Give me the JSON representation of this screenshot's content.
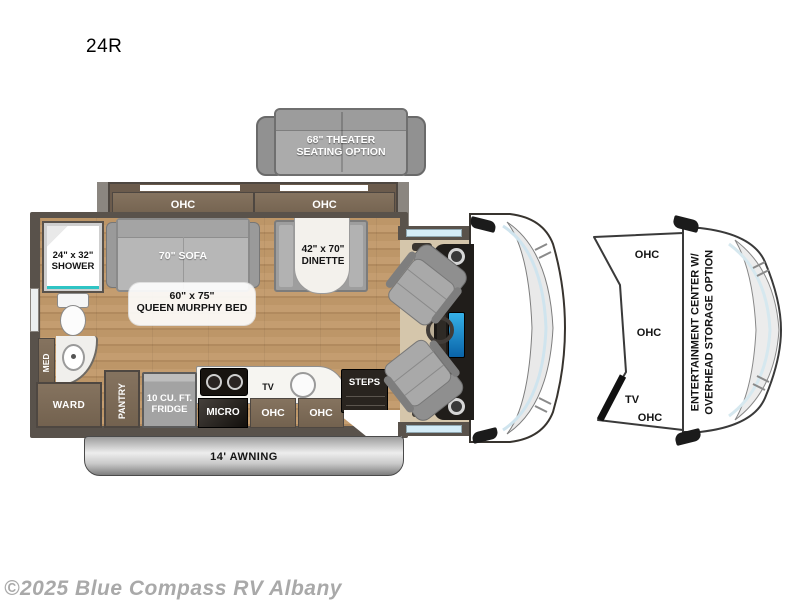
{
  "page": {
    "title": "24R",
    "watermark": "©2025 Blue Compass RV Albany"
  },
  "colors": {
    "accent_teal": "#2fc4c4",
    "wood_floor": "#c09a6e",
    "wall": "#59524b",
    "cabinet_brown": "#7b6a59",
    "infotainment_blue": "#2f9fd8",
    "awning_silver": "#c8c8c8",
    "watermark_gray": "#a9a9a9"
  },
  "floorplan": {
    "theater": {
      "line1": "68\" THEATER",
      "line2": "SEATING OPTION"
    },
    "slideout": {
      "ohc_left": "OHC",
      "ohc_right": "OHC"
    },
    "sofa": {
      "label": "70\" SOFA"
    },
    "murphy_bed": {
      "line1": "60\" x 75\"",
      "line2": "QUEEN MURPHY BED"
    },
    "dinette": {
      "line1": "42\" x 70\"",
      "line2": "DINETTE"
    },
    "shower": {
      "line1": "24\" x 32\"",
      "line2": "SHOWER"
    },
    "med": {
      "label": "MED"
    },
    "ward": {
      "label": "WARD"
    },
    "pantry": {
      "label": "PANTRY"
    },
    "fridge": {
      "line1": "10 CU. FT.",
      "line2": "FRIDGE"
    },
    "micro": {
      "label": "MICRO"
    },
    "kitchen_ohc_left": {
      "label": "OHC"
    },
    "kitchen_ohc_right": {
      "label": "OHC"
    },
    "tv": {
      "label": "TV"
    },
    "steps": {
      "label": "STEPS"
    },
    "awning": {
      "label": "14' AWNING"
    }
  },
  "option_diagram": {
    "ohc_top": "OHC",
    "ohc_middle": "OHC",
    "tv": "TV",
    "ohc_bottom": "OHC",
    "title_line1": "ENTERTAINMENT CENTER W/",
    "title_line2": "OVERHEAD STORAGE OPTION"
  }
}
